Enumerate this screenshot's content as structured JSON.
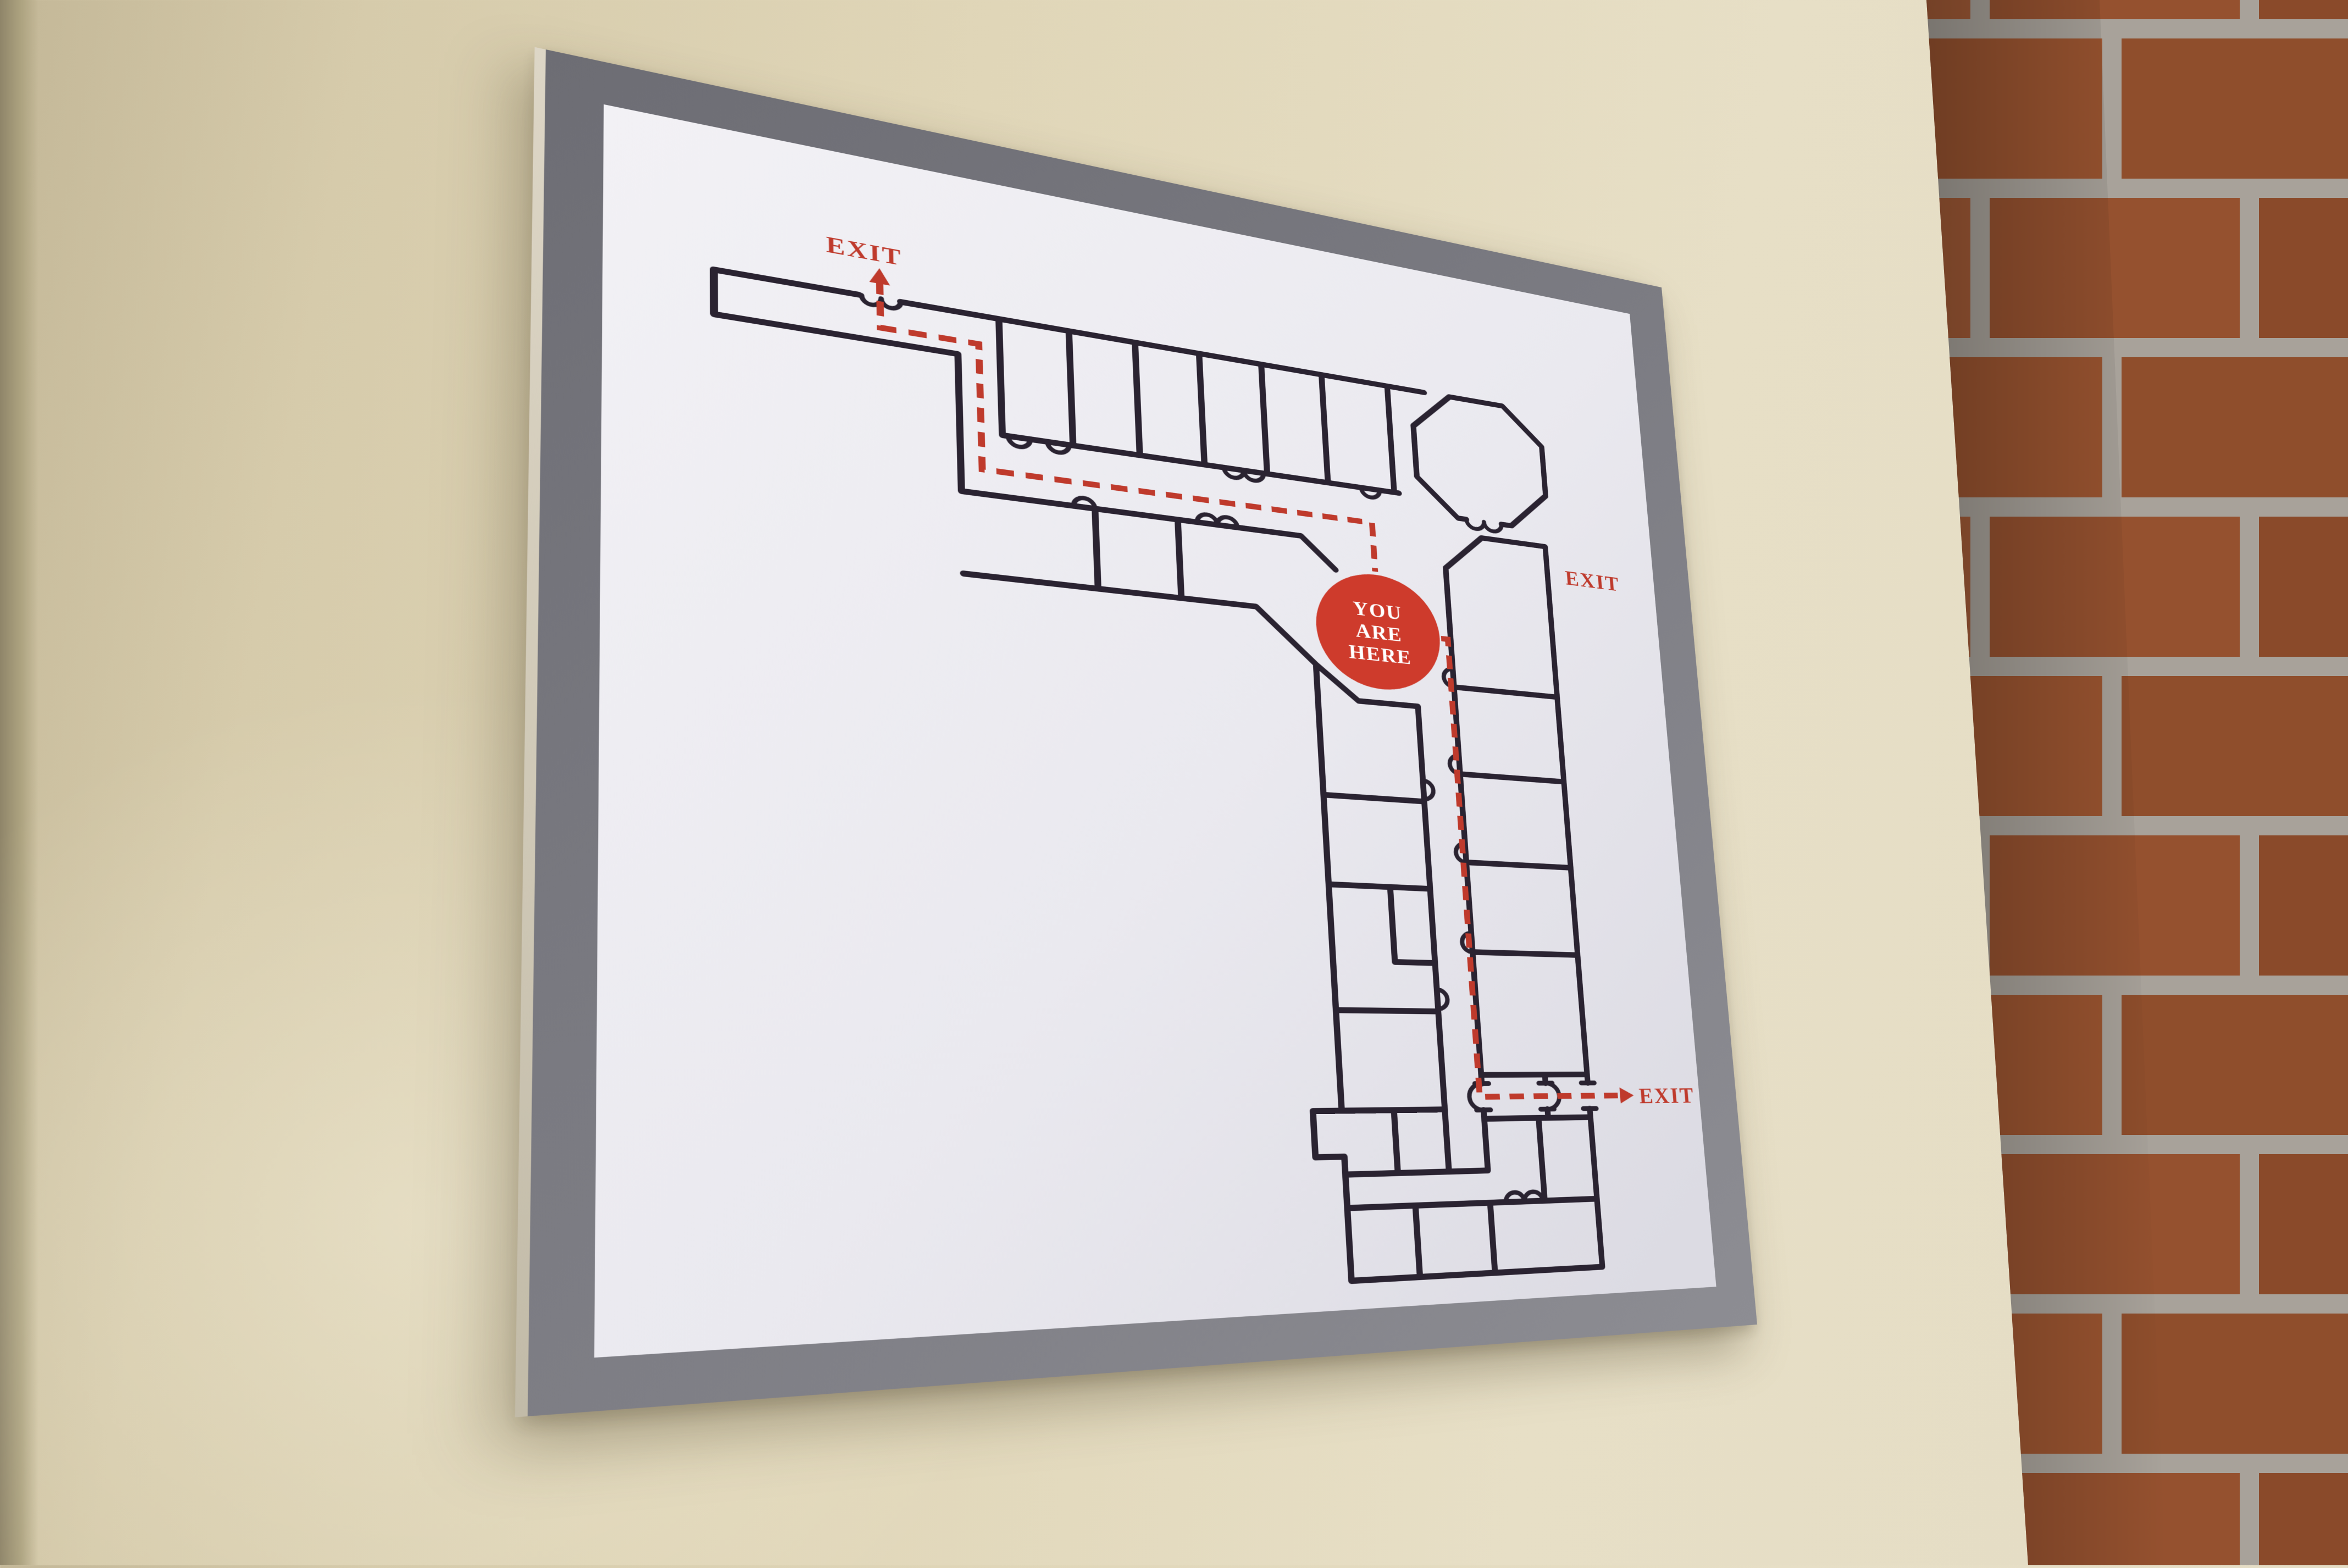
{
  "scene": {
    "description_wall_color": "#e0d6b8",
    "wall_corner_shade_color": "#8f8569",
    "brick_color": "#96522f",
    "mortar_color": "#a8a29a"
  },
  "sign": {
    "frame_color": "#7b7b82",
    "paper_color": "#ebeaf0",
    "wall_line_color": "#2a2331",
    "route_color": "#bf3a2c",
    "marker_fill_color": "#ce3b2c",
    "labels": {
      "exit_top_left": "EXIT",
      "exit_middle_right": "EXIT",
      "exit_bottom_right": "EXIT"
    },
    "marker": {
      "line1": "YOU",
      "line2": "ARE",
      "line3": "HERE"
    }
  }
}
